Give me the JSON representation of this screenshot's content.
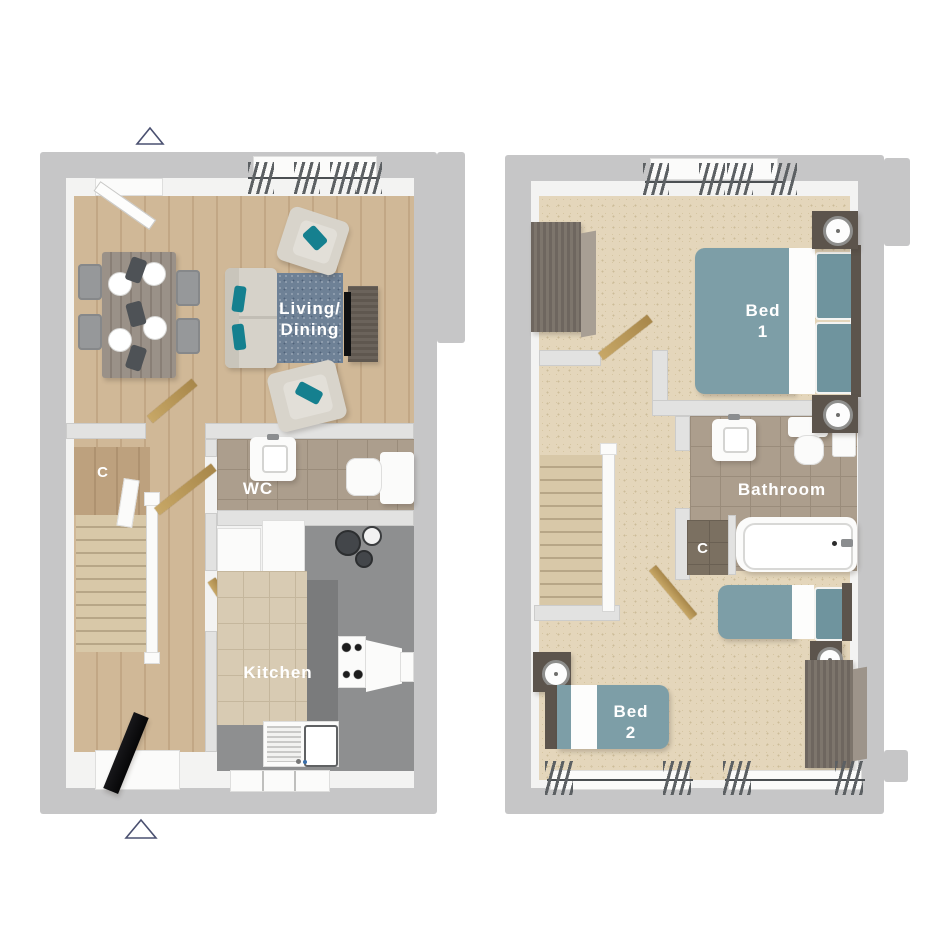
{
  "plans": {
    "left": {
      "living_dining": {
        "line1": "Living/",
        "line2": "Dining"
      },
      "cupboard_label": "C",
      "wc_label": "WC",
      "kitchen_label": "Kitchen"
    },
    "right": {
      "bed1": {
        "line1": "Bed",
        "line2": "1"
      },
      "bathroom_label": "Bathroom",
      "cupboard_label": "C",
      "bed2": {
        "line1": "Bed",
        "line2": "2"
      }
    }
  },
  "colors": {
    "background": "#ffffff",
    "outer_wall": "#c6c6c7",
    "inner_wall_face": "#f3f3f2",
    "wood_floor": "#cbb191",
    "carpet": "#e4d6bb",
    "bathroom_tile": "#ac9e8d",
    "kitchen_tile": "#d8cbb3",
    "kitchen_counter": "#8e8f90",
    "bed_teal": "#7d9ea7",
    "accent_teal": "#15808f",
    "rug_blue": "#6e8196",
    "door_gold": "#b2924f",
    "dark_wood_furniture": "#5c544c",
    "label_text": "#ffffff",
    "entry_marker_outline": "#4a5070"
  }
}
